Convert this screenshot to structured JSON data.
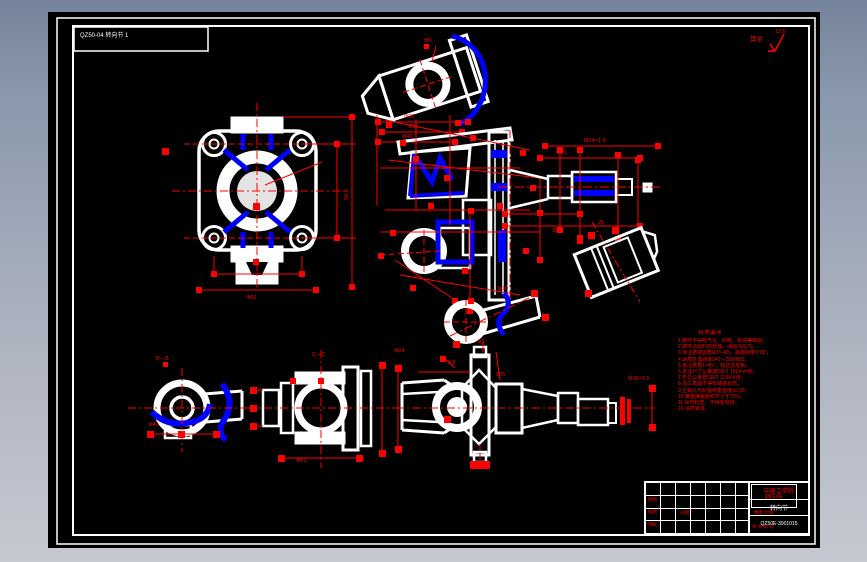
{
  "window": {
    "bg_top": "#76849b",
    "bg_bottom": "#c6c9d2"
  },
  "canvas": {
    "bg": "#000000",
    "frame_color": "#ffffff"
  },
  "colors": {
    "line": "#ffffff",
    "dimension": "#ff0000",
    "accent": "#0000ff"
  },
  "header_label": {
    "text": "QZ50-04 转向节 1"
  },
  "surface_note": {
    "prefix": "其余",
    "value": "12.5"
  },
  "dims": [
    "Φ9",
    "Φ25",
    "Φ30",
    "Φ40",
    "50.8",
    "Φ62",
    "M24×1.5",
    "Φ30",
    "302",
    "25",
    "B—B",
    "C—C",
    "Φ9",
    "1:8",
    "105",
    "M18×1.5",
    "Φ24",
    "Φ40",
    "Φ52",
    "R10"
  ],
  "notes": {
    "title": "技术要求",
    "lines": [
      "1.铸件不得有气孔、砂眼、裂纹等缺陷；",
      "2.铸件须经时效处理，消除内应力；",
      "3.未注铸造圆角R3～R5，拔模斜度1°30′；",
      "4.调质处理硬度241～285HBS；",
      "5.未注倒角1×45°，锐边去毛刺；",
      "6.未注尺寸公差按GB/T 1804-m级；",
      "7.形位公差按GB/T 1184-K级；",
      "8.加工表面不得有磕碰划伤；",
      "9.主销孔与轮轴线垂直度≤0.05；",
      "10.锥面接触面积不小于75%；",
      "11.探伤检查，不得有裂纹；",
      "12.涂防锈漆。"
    ]
  },
  "title_block": {
    "school": "中原工学院",
    "part_name": "转向节",
    "drawing_no": "QZ50E-3001015",
    "mid_label": "转向节",
    "zhitu": "制图",
    "miaotu": "描图",
    "shenhe": "审核",
    "material": "45钢",
    "qty_scale": "数量 比例",
    "sheets": "共 张 第 张"
  }
}
